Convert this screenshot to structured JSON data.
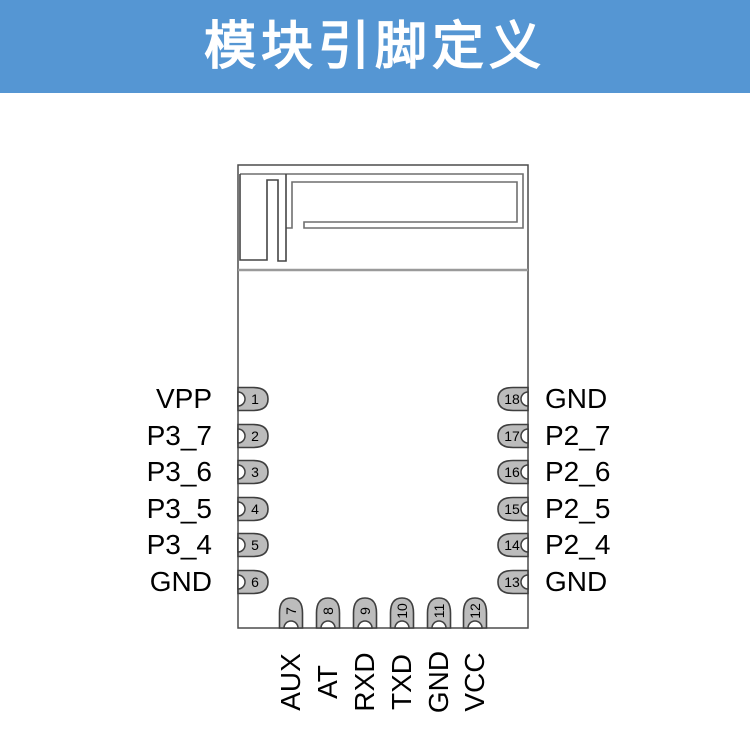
{
  "header": {
    "title": "模块引脚定义"
  },
  "colors": {
    "header_bg": "#5596d3",
    "header_text": "#ffffff",
    "module_outline": "#4c4c4c",
    "antenna_line": "#6f6f6f",
    "antenna_line_dark": "#454545",
    "separator": "#9a9a9a",
    "pin_fill": "#bcbcbc",
    "pin_stroke": "#3f3f3f",
    "label_color": "#000000"
  },
  "module": {
    "left_pins": [
      {
        "num": "1",
        "label": "VPP"
      },
      {
        "num": "2",
        "label": "P3_7"
      },
      {
        "num": "3",
        "label": "P3_6"
      },
      {
        "num": "4",
        "label": "P3_5"
      },
      {
        "num": "5",
        "label": "P3_4"
      },
      {
        "num": "6",
        "label": "GND"
      }
    ],
    "right_pins": [
      {
        "num": "18",
        "label": "GND"
      },
      {
        "num": "17",
        "label": "P2_7"
      },
      {
        "num": "16",
        "label": "P2_6"
      },
      {
        "num": "15",
        "label": "P2_5"
      },
      {
        "num": "14",
        "label": "P2_4"
      },
      {
        "num": "13",
        "label": "GND"
      }
    ],
    "bottom_pins": [
      {
        "num": "7",
        "label": "AUX"
      },
      {
        "num": "8",
        "label": "AT"
      },
      {
        "num": "9",
        "label": "RXD"
      },
      {
        "num": "10",
        "label": "TXD"
      },
      {
        "num": "11",
        "label": "GND"
      },
      {
        "num": "12",
        "label": "VCC"
      }
    ]
  }
}
